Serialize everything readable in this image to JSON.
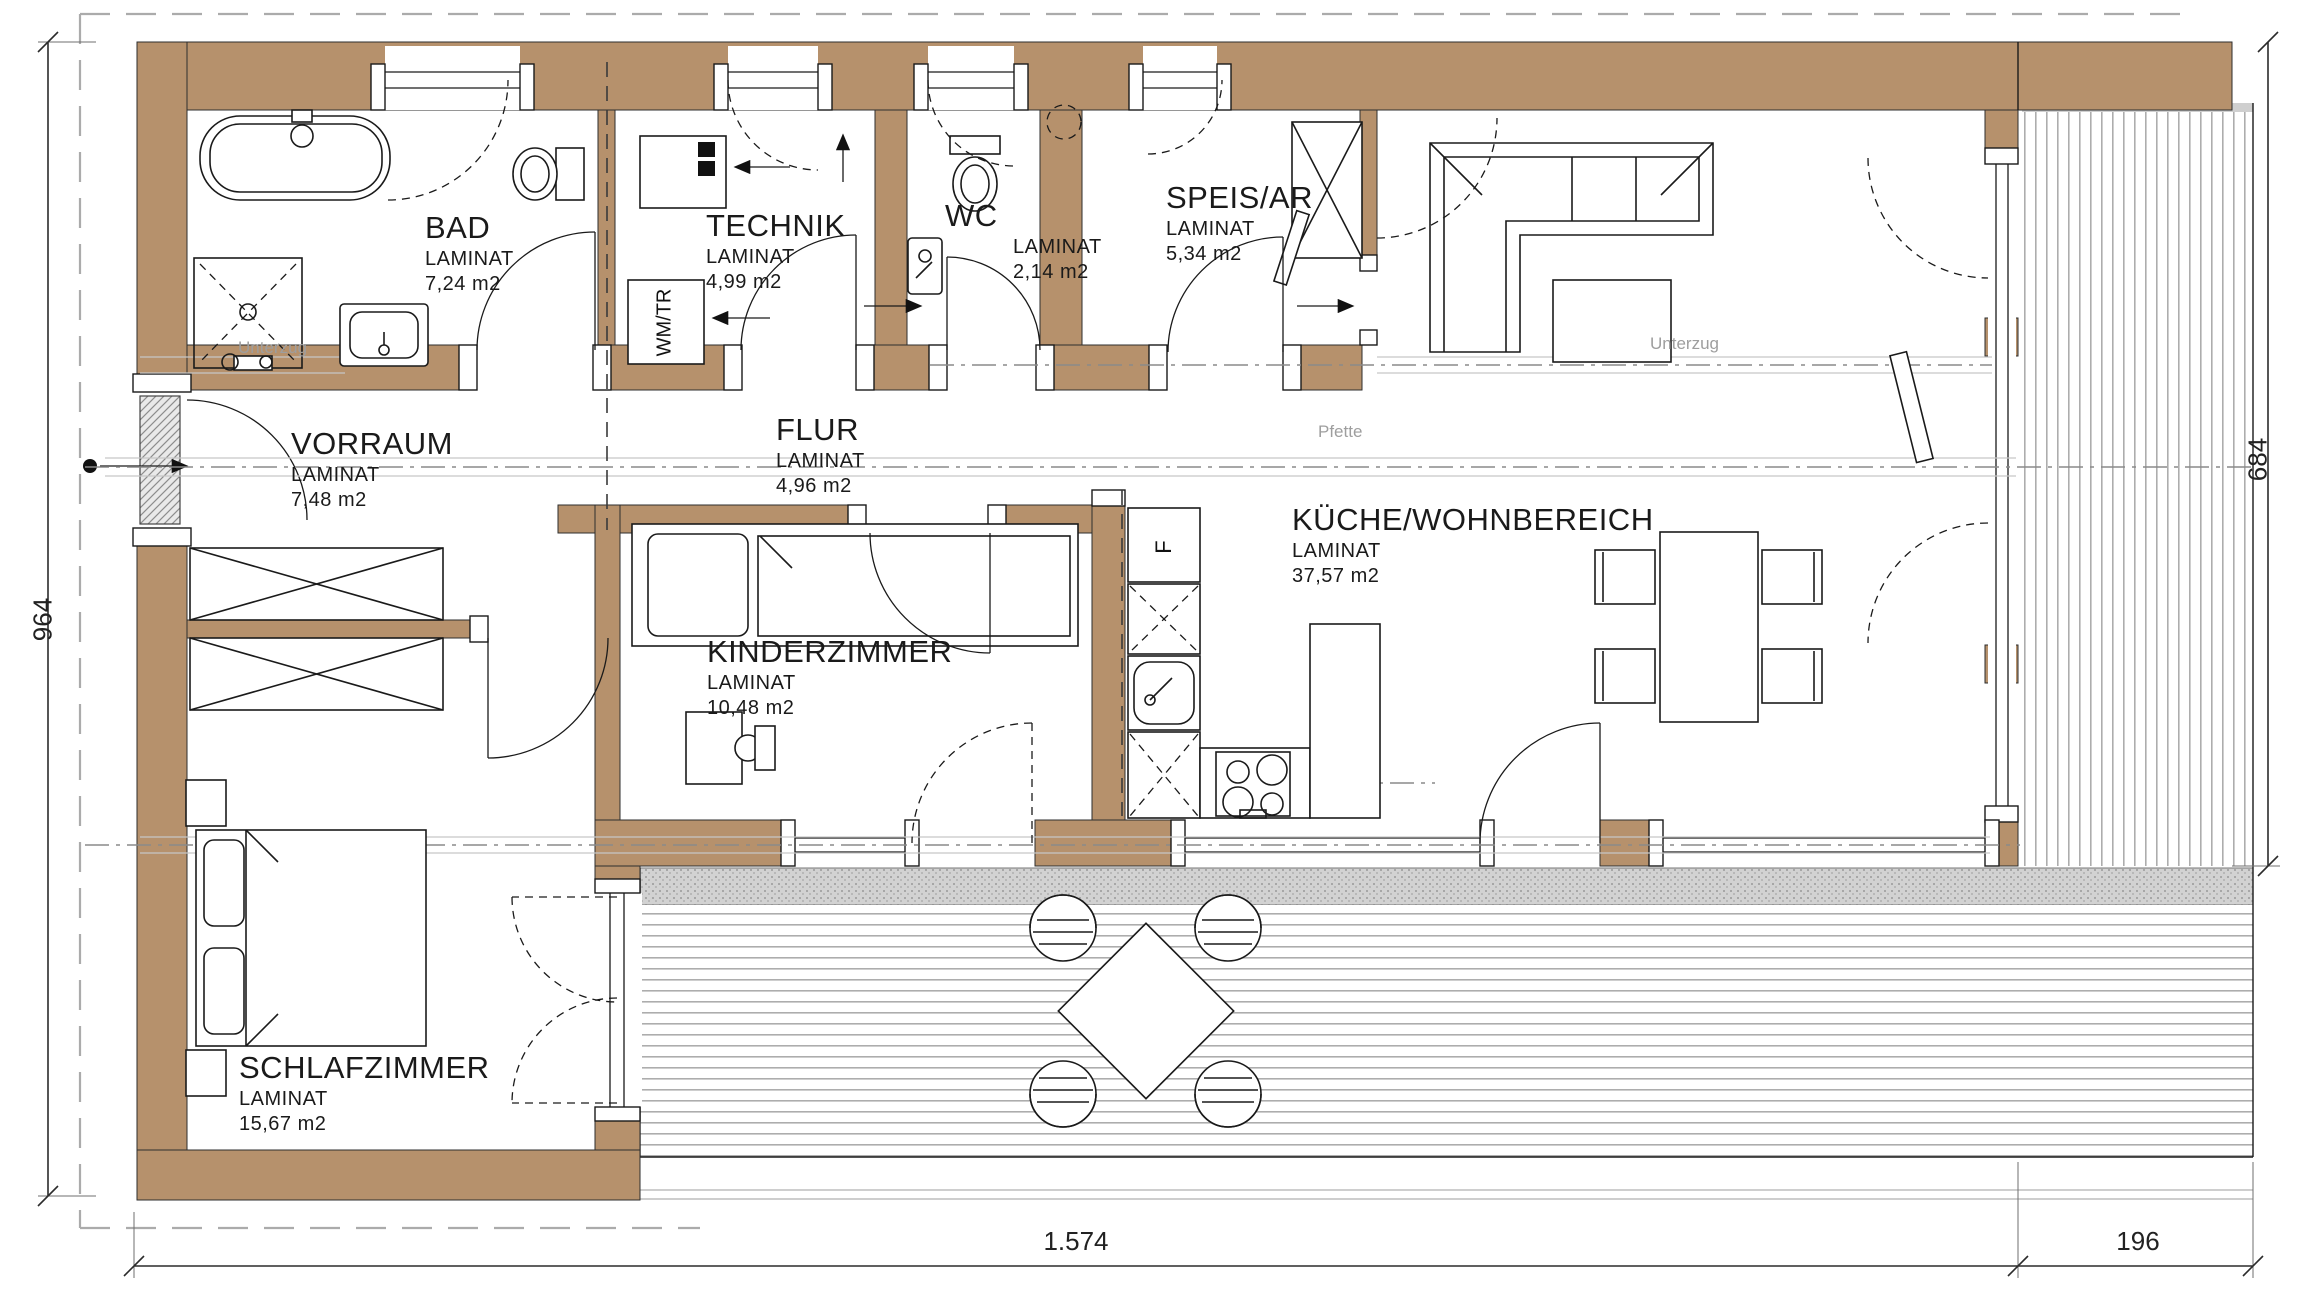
{
  "plan": {
    "rooms": [
      {
        "name": "BAD",
        "floor": "LAMINAT",
        "area": "7,24 m2"
      },
      {
        "name": "TECHNIK",
        "floor": "LAMINAT",
        "area": "4,99 m2"
      },
      {
        "name": "WC",
        "floor": "LAMINAT",
        "area": "2,14 m2"
      },
      {
        "name": "SPEIS/AR",
        "floor": "LAMINAT",
        "area": "5,34 m2"
      },
      {
        "name": "VORRAUM",
        "floor": "LAMINAT",
        "area": "7,48 m2"
      },
      {
        "name": "FLUR",
        "floor": "LAMINAT",
        "area": "4,96 m2"
      },
      {
        "name": "KÜCHE/WOHNBEREICH",
        "floor": "LAMINAT",
        "area": "37,57 m2"
      },
      {
        "name": "KINDERZIMMER",
        "floor": "LAMINAT",
        "area": "10,48 m2"
      },
      {
        "name": "SCHLAFZIMMER",
        "floor": "LAMINAT",
        "area": "15,67 m2"
      }
    ],
    "annotations": {
      "pfette": "Pfette",
      "unterzug_left": "Unterzug",
      "unterzug_right": "Unterzug",
      "washer_dryer": "WM/TR",
      "fridge": "F"
    },
    "dimensions": {
      "left_depth": "964",
      "right_depth": "684",
      "bottom_width": "1.574",
      "bottom_terrace": "196"
    },
    "colors": {
      "wall": "#b6916c",
      "deck_line": "#adadad",
      "axis_gray": "#9e9e9e",
      "line": "#1a1a1a"
    }
  }
}
